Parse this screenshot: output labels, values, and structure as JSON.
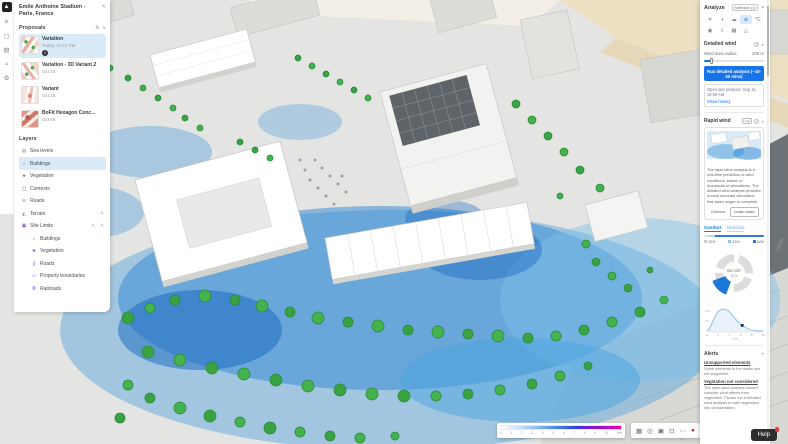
{
  "window": {
    "title": "Emile Anthoine Stadium - Paris, France",
    "edit_icon": "✎"
  },
  "left_rail": {
    "logo_glyph": "▲",
    "icons": [
      {
        "name": "menu-icon",
        "glyph": "≡"
      },
      {
        "name": "design-icon",
        "glyph": "▢"
      },
      {
        "name": "library-icon",
        "glyph": "▤"
      },
      {
        "name": "analyze-rail-icon",
        "glyph": "≈"
      },
      {
        "name": "settings-icon",
        "glyph": "⚙"
      }
    ]
  },
  "proposals": {
    "header": "Proposals",
    "sort_icon": "⇅",
    "collapse_icon": "∨",
    "items": [
      {
        "name": "Variation",
        "date": "Today, 10:21 PM",
        "badge": "1"
      },
      {
        "name": "Variation - 3D Variant 2",
        "date": "Oct 23"
      },
      {
        "name": "Variant",
        "date": "Oct 26"
      },
      {
        "name": "BoFit Hexagon Conc...",
        "date": "Oct 26"
      }
    ]
  },
  "layers": {
    "header": "Layers",
    "items": [
      {
        "label": "Sea levels",
        "glyph": "◍"
      },
      {
        "label": "Buildings",
        "glyph": "⌂"
      },
      {
        "label": "Vegetation",
        "glyph": "♣"
      },
      {
        "label": "Contexts",
        "glyph": "◫"
      },
      {
        "label": "Roads",
        "glyph": "≋"
      },
      {
        "label": "Terrain",
        "glyph": "◭",
        "edit": "✎"
      },
      {
        "label": "Site Limits",
        "glyph": "▣",
        "edit": "✎",
        "edit2": "✎"
      }
    ],
    "sub_items": [
      {
        "label": "Buildings",
        "glyph": "⌂"
      },
      {
        "label": "Vegetation",
        "glyph": "♣"
      },
      {
        "label": "Roads",
        "glyph": "∥"
      },
      {
        "label": "Property boundaries",
        "glyph": "▱"
      },
      {
        "label": "Railroads",
        "glyph": "≣"
      }
    ]
  },
  "viewport": {
    "street_label": "Chirac"
  },
  "speed_legend": {
    "ticks": [
      "0",
      "1",
      "2",
      "3",
      "4",
      "5",
      "6",
      "7",
      "8",
      "9",
      "10"
    ],
    "unit": "m/s"
  },
  "viewport_toolbar": {
    "icons": [
      {
        "name": "grid-icon",
        "glyph": "▦"
      },
      {
        "name": "eye-icon",
        "glyph": "◎"
      },
      {
        "name": "camera-icon",
        "glyph": "▣"
      },
      {
        "name": "expand-icon",
        "glyph": "⊡"
      },
      {
        "name": "more-icon",
        "glyph": "⋯"
      },
      {
        "name": "record-icon",
        "glyph": "●"
      }
    ]
  },
  "analyze": {
    "title": "Analyze",
    "selection_chip": "Selection (1)",
    "close_icon": "×",
    "icons": [
      {
        "name": "sun-hours-icon",
        "glyph": "☀"
      },
      {
        "name": "daylight-icon",
        "glyph": "◑"
      },
      {
        "name": "microclimate-icon",
        "glyph": "☁"
      },
      {
        "name": "wind-icon",
        "glyph": "≋"
      },
      {
        "name": "thermal-icon",
        "glyph": "℃"
      },
      {
        "name": "noise-icon",
        "glyph": "◉"
      },
      {
        "name": "solar-energy-icon",
        "glyph": "☇"
      },
      {
        "name": "area-metrics-icon",
        "glyph": "▦"
      },
      {
        "name": "terrain-analysis-icon",
        "glyph": "△"
      }
    ],
    "detailed_wind": {
      "header": "Detailed wind",
      "help_icon": "?",
      "collapse_icon": "∧",
      "area_label": "Wind area radius",
      "area_value": "200 m",
      "run_button": "Run detailed analysis (~10-50 mins)",
      "last_analysis": "Open last analysis: Sep 15, 10:59 AM",
      "history_link": "Show history"
    },
    "rapid_wind": {
      "header": "Rapid wind",
      "badge": "LIVE",
      "help_icon": "?",
      "collapse_icon": "∧",
      "info_text": "The rapid wind analysis is a real-time prediction of wind conditions, based on thousands of simulations. The detailed wind analysis provides a more accurate calculation that takes longer to complete.",
      "dismiss_button": "Dismiss",
      "learn_more_button": "Learn more",
      "tabs": [
        {
          "label": "Comfort"
        },
        {
          "label": "Direction"
        }
      ],
      "legend_chips": [
        {
          "color": "#c9c9c9",
          "label": "33%"
        },
        {
          "color": "#8fbfe8",
          "label": "33%"
        },
        {
          "color": "#1f6fd4",
          "label": "64%"
        }
      ],
      "wind_rose": {
        "direction": "SW 225°",
        "percent": "32%"
      },
      "speed_chart": {
        "x_ticks": [
          "0",
          "2",
          "4",
          "6",
          "8",
          "10"
        ],
        "unit": "m/s",
        "y_ticks": [
          "10%",
          "5%",
          "0"
        ]
      }
    },
    "alerts": {
      "header": "Alerts",
      "collapse_icon": "∧",
      "items": [
        {
          "title": "Unsupported elements",
          "body": "Some elements in the model are not supported."
        },
        {
          "title": "Vegetation not considered",
          "body": "The rapid wind analysis doesn't consider wind effects from vegetation. Please run a detailed wind analysis to take vegetation into consideration."
        }
      ]
    }
  },
  "help_button": {
    "label": "Help"
  },
  "accent_colors": {
    "primary_blue": "#1872e8",
    "selection_bg": "#d9eaf8",
    "purple": "#8a63d2",
    "magenta": "#e800b0"
  },
  "chart_data": [
    {
      "type": "pie",
      "title": "Wind direction rose",
      "center_label": "SW 225°",
      "center_value": "32%",
      "slices": [
        {
          "label": "SW",
          "value": 32,
          "color": "#1a78d6",
          "highlighted": true
        },
        {
          "label": "other directions",
          "value": 68,
          "color": "#dcdcda"
        }
      ],
      "legend_position": "center"
    },
    {
      "type": "area",
      "title": "Wind speed distribution",
      "xlabel": "m/s",
      "ylabel": "%",
      "x": [
        0,
        1,
        2,
        3,
        4,
        5,
        6,
        7,
        8,
        9,
        10
      ],
      "values": [
        1,
        4,
        9,
        11,
        9,
        6.5,
        4.5,
        3,
        2,
        1.2,
        0.8
      ],
      "marker_x": 6.5,
      "xlim": [
        0,
        10
      ],
      "ylim": [
        0,
        12
      ],
      "grid": false
    }
  ]
}
